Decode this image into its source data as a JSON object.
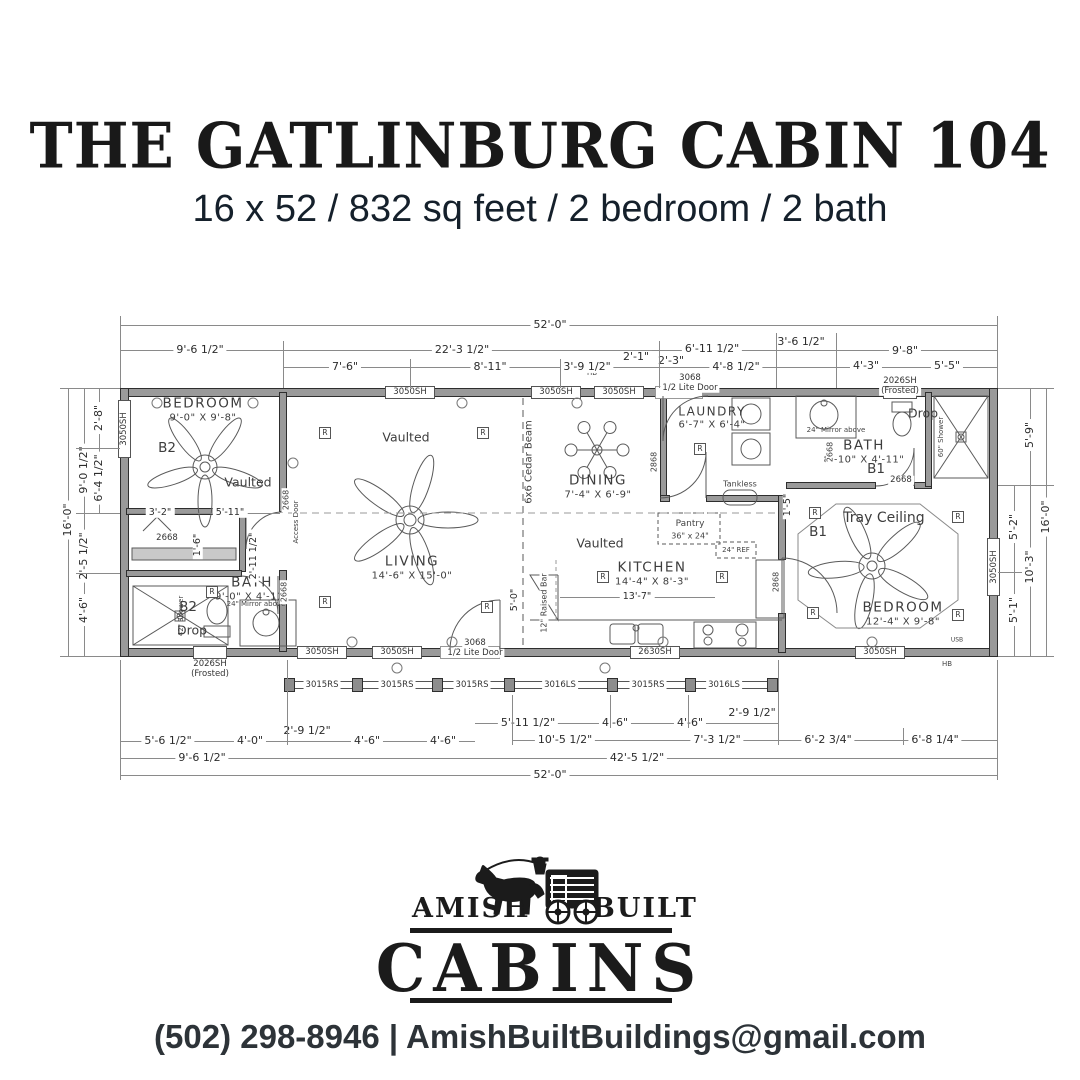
{
  "header": {
    "title": "THE GATLINBURG CABIN 104",
    "subtitle": "16 x 52 / 832 sq feet / 2 bedroom / 2 bath"
  },
  "dims": {
    "top0": "52'-0\"",
    "top1": [
      "9'-6 1/2\"",
      "22'-3 1/2\"",
      "6'-11 1/2\"",
      "3'-6 1/2\"",
      "9'-8\""
    ],
    "top2": [
      "7'-6\"",
      "8'-11\"",
      "3'-9 1/2\"",
      "2'-1\"",
      "2'-3\"",
      "4'-8 1/2\"",
      "4'-3\"",
      "5'-5\""
    ],
    "left": [
      "16'-0\"",
      "2'-8\"",
      "9'-0 1/2\"",
      "6'-4 1/2\"",
      "2'-5 1/2\"",
      "4'-6\""
    ],
    "right": [
      "5'-9\"",
      "5'-2\"",
      "10'-3\"",
      "5'-1\"",
      "16'-0\""
    ],
    "botA": [
      "5'-6 1/2\"",
      "4'-0\"",
      "2'-9 1/2\"",
      "4'-6\"",
      "4'-6\"",
      "5'-11 1/2\"",
      "4'-6\"",
      "4'-6\"",
      "2'-9 1/2\""
    ],
    "botB": [
      "10'-5 1/2\"",
      "7'-3 1/2\"",
      "6'-2 3/4\"",
      "6'-8 1/4\""
    ],
    "botC": [
      "9'-6 1/2\"",
      "42'-5 1/2\""
    ],
    "bot0": "52'-0\"",
    "inner": {
      "bed2a": "3'-2\"",
      "bed2b": "5'-11\"",
      "closet": "1'-6\"",
      "hall": "2'-11 1/2\"",
      "kitchen": "13'-7\"",
      "bar": "5'-0\"",
      "bed1": "1'-5\""
    }
  },
  "rooms": {
    "bed2": {
      "name": "BEDROOM",
      "size": "9'-0\" X 9'-8\"",
      "tag": "B2",
      "ceil": "Vaulted"
    },
    "bath2": {
      "name": "BATH",
      "size": "9'-0\" X 4'-11\"",
      "tag": "B2",
      "note": "Drop"
    },
    "living": {
      "name": "LIVING",
      "size": "14'-6\" X 15'-0\"",
      "ceil": "Vaulted"
    },
    "dining": {
      "name": "DINING",
      "size": "7'-4\" X 6'-9\""
    },
    "kitchen": {
      "name": "KITCHEN",
      "size": "14'-4\" X 8'-3\"",
      "ceil": "Vaulted"
    },
    "laundry": {
      "name": "LAUNDRY",
      "size": "6'-7\" X 6'-4\""
    },
    "bath1": {
      "name": "BATH",
      "size": "8'-10\" X 4'-11\"",
      "tag": "B1",
      "note": "Drop"
    },
    "bed1": {
      "name": "BEDROOM",
      "size": "12'-4\" X 9'-8\"",
      "tag": "B1",
      "ceil": "Tray Ceiling"
    }
  },
  "labels": {
    "w3050": "3050SH",
    "w2026a": "2026SH",
    "w2026b": "(Frosted)",
    "w2630": "2630SH",
    "d3068a": "3068",
    "d3068b": "1/2 Lite Door",
    "d2668": "2668",
    "d2868": "2868",
    "rail_rs": "3015RS",
    "rail_ls": "3016LS",
    "beam": "6x6 Cedar Beam",
    "bar": "12\" Raised Bar",
    "access": "Access Door",
    "tankless": "Tankless",
    "pantry": "Pantry",
    "pantry_size": "36\" x 24\"",
    "ref": "24\" REF",
    "mirror": "24\" Mirror above",
    "shower_l": "42\" Shower",
    "shower_r": "60\" Shower",
    "r": "R",
    "hb": "HB",
    "usb": "USB"
  },
  "logo": {
    "amish": "AMISH",
    "built": "BUILT",
    "cabins": "CABINS"
  },
  "contact": "(502) 298-8946 | AmishBuiltBuildings@gmail.com"
}
